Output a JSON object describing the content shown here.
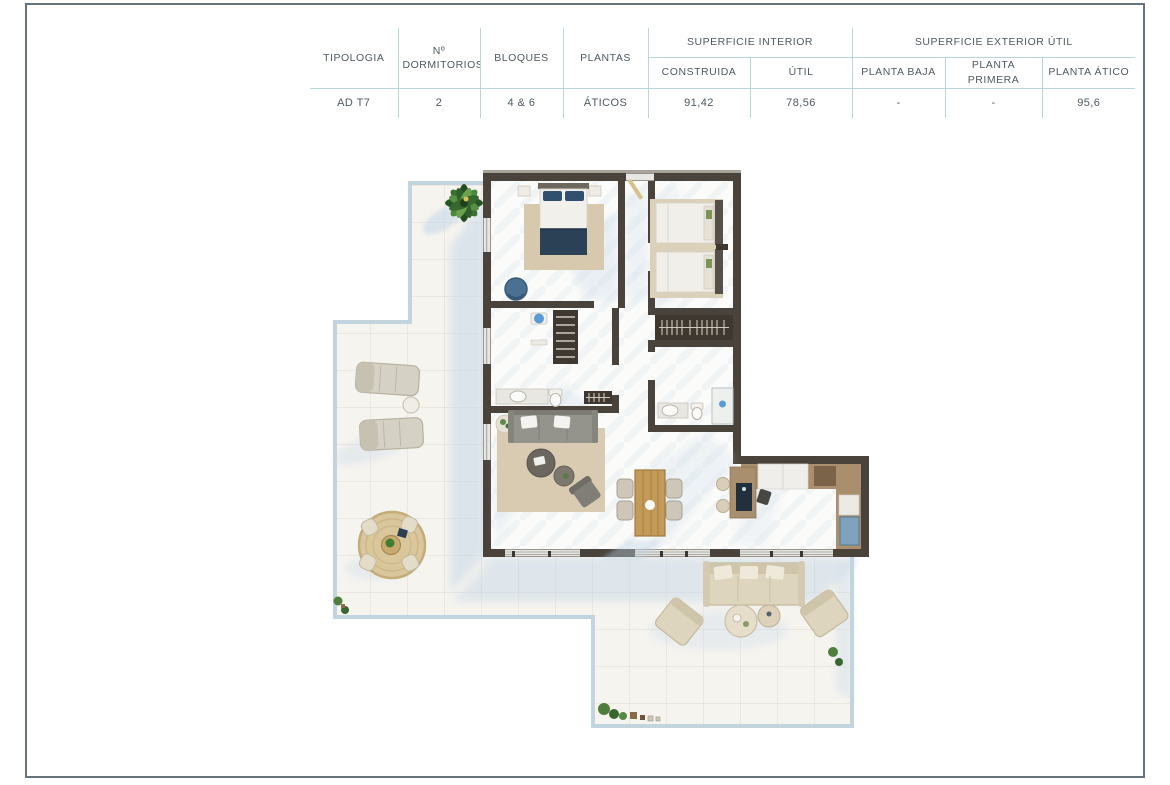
{
  "page": {
    "border_color": "#66727c",
    "background": "#ffffff"
  },
  "table": {
    "headers": {
      "tipologia": "TIPOLOGIA",
      "dormitorios": "Nº DORMITORIOS",
      "bloques": "BLOQUES",
      "plantas": "PLANTAS",
      "superficie_interior": "SUPERFICIE INTERIOR",
      "superficie_exterior": "SUPERFICIE EXTERIOR ÚTIL",
      "construida": "CONSTRUIDA",
      "util": "ÚTIL",
      "planta_baja": "PLANTA BAJA",
      "planta_primera": "PLANTA PRIMERA",
      "planta_atico": "PLANTA ÁTICO"
    },
    "row": {
      "tipologia": "AD T7",
      "dormitorios": "2",
      "bloques": "4 & 6",
      "plantas": "ÁTICOS",
      "construida": "91,42",
      "util": "78,56",
      "planta_baja": "-",
      "planta_primera": "-",
      "planta_atico": "95,6"
    }
  },
  "floorplan": {
    "type": "penthouse-apartment-top-view-render",
    "rooms": [
      "master-bedroom",
      "bedroom-2",
      "bathroom-1",
      "bathroom-2",
      "hallway",
      "living-dining",
      "kitchen",
      "wrap-around-terrace"
    ],
    "palette": {
      "wall": "#4a433b",
      "wall_top": "#a7a39a",
      "interior_floor": "#fbfbf9",
      "terrace_floor": "#f6f4ef",
      "terrace_edge": "#c2d4de",
      "shadow": "#c3d6e8",
      "rug": "#d7c9ae",
      "navy": "#2b4156",
      "wood": "#c49a58",
      "sofa_gray": "#94938c",
      "outdoor_beige": "#ded5bf",
      "kitchen_tan": "#a98f6e",
      "appliance_navy": "#22303e",
      "appliance_blue": "#7fa3bd",
      "plant_green": "#3f7d33",
      "fixture_blue": "#5b9bd5",
      "closet_dark": "#3e3830"
    }
  }
}
